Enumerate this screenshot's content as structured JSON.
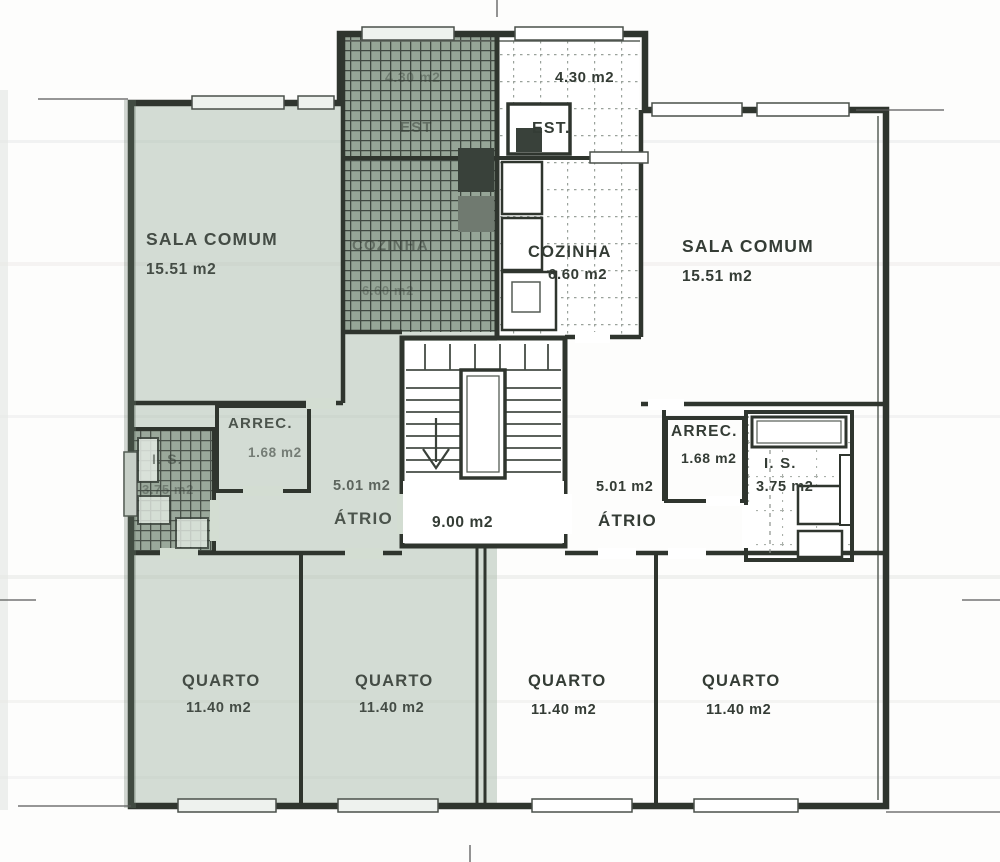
{
  "plan": {
    "stair_landing": {
      "area": "9.00 m2"
    },
    "left_apartment": {
      "est": {
        "name": "EST",
        "area": "4.30 m2"
      },
      "cozinha": {
        "name": "COZINHA",
        "area": "6.60 m2"
      },
      "sala_comum": {
        "name": "SALA COMUM",
        "area": "15.51 m2"
      },
      "arrec": {
        "name": "ARREC.",
        "area": "1.68 m2"
      },
      "is": {
        "name": "I. S.",
        "area": "3.75 m2"
      },
      "atrio": {
        "name": "ÁTRIO",
        "area": "5.01 m2"
      },
      "quarto_1": {
        "name": "QUARTO",
        "area": "11.40 m2"
      },
      "quarto_2": {
        "name": "QUARTO",
        "area": "11.40 m2"
      }
    },
    "right_apartment": {
      "est": {
        "name": "EST.",
        "area": "4.30 m2"
      },
      "cozinha": {
        "name": "COZINHA",
        "area": "6.60 m2"
      },
      "sala_comum": {
        "name": "SALA COMUM",
        "area": "15.51 m2"
      },
      "arrec": {
        "name": "ARREC.",
        "area": "1.68 m2"
      },
      "is": {
        "name": "I. S.",
        "area": "3.75 m2"
      },
      "atrio": {
        "name": "ÁTRIO",
        "area": "5.01 m2"
      },
      "quarto_1": {
        "name": "QUARTO",
        "area": "11.40 m2"
      },
      "quarto_2": {
        "name": "QUARTO",
        "area": "11.40 m2"
      }
    }
  },
  "colors": {
    "wall": "#2f352e",
    "left_unit_tint": "#a9bcab",
    "paper": "#fdfdfc"
  }
}
